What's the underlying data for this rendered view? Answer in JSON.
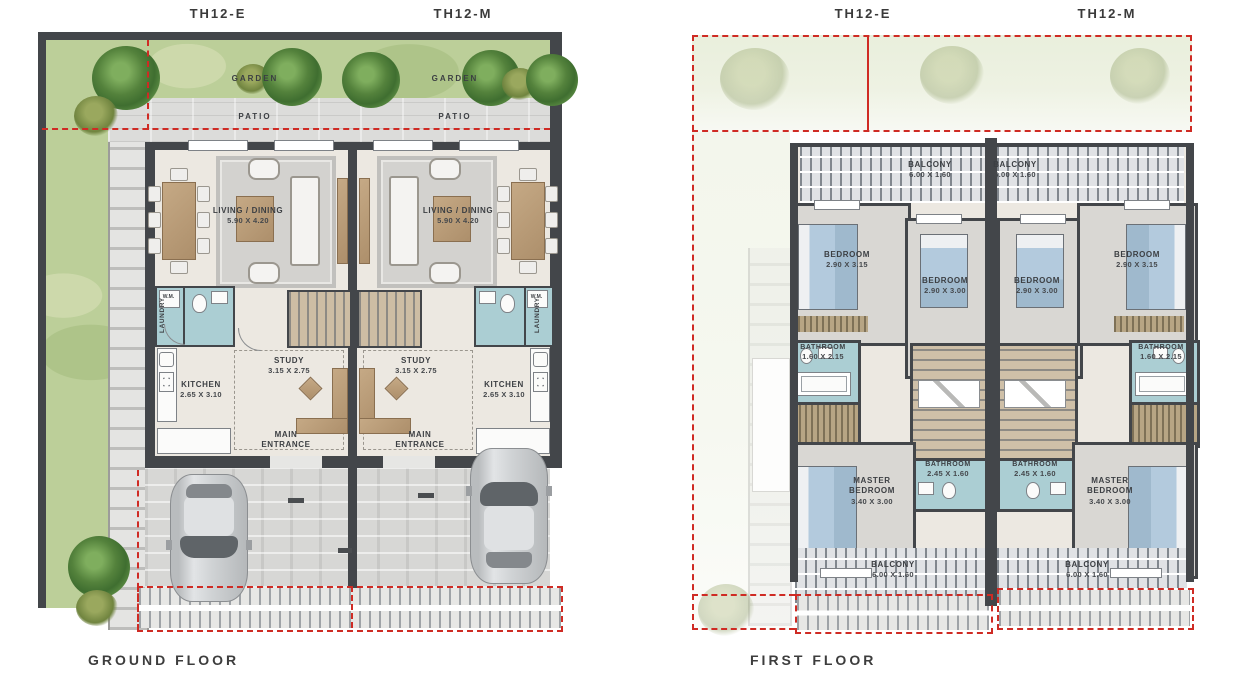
{
  "document": {
    "type": "architectural floor plan",
    "captions": {
      "ground": "GROUND FLOOR",
      "first": "FIRST FLOOR"
    },
    "units": {
      "left": "TH12-E",
      "right": "TH12-M"
    }
  },
  "ground_floor": {
    "rooms": {
      "garden": "GARDEN",
      "patio": "PATIO",
      "living_dining": "LIVING / DINING",
      "living_dining_dims": "5.90 X 4.20",
      "study": "STUDY",
      "study_dims": "3.15 X 2.75",
      "kitchen": "KITCHEN",
      "kitchen_dims": "2.65 X 3.10",
      "main_entrance": "MAIN ENTRANCE",
      "laundry": "LAUNDRY",
      "washing_machine": "W.M."
    }
  },
  "first_floor": {
    "rooms": {
      "balcony": "BALCONY",
      "balcony_dims": "6.00 X 1.60",
      "bedroom_corner": "BEDROOM",
      "bedroom_corner_dims": "2.90 X 3.15",
      "bedroom_mid": "BEDROOM",
      "bedroom_mid_dims": "2.90 X 3.00",
      "bathroom_side": "BATHROOM",
      "bathroom_side_dims": "1.60 X 2.15",
      "bathroom_center": "BATHROOM",
      "bathroom_center_dims": "2.45 X 1.60",
      "master_bedroom": "MASTER BEDROOM",
      "master_bedroom_dims": "3.40 X 3.00"
    }
  },
  "colors": {
    "wall": "#43464a",
    "garden": "#bccf99",
    "bathroom": "#abced3",
    "boundary_red": "#cf2b24",
    "floor": "#ece8e1",
    "wood": "#b79c79",
    "bed": "#b3cadd"
  }
}
